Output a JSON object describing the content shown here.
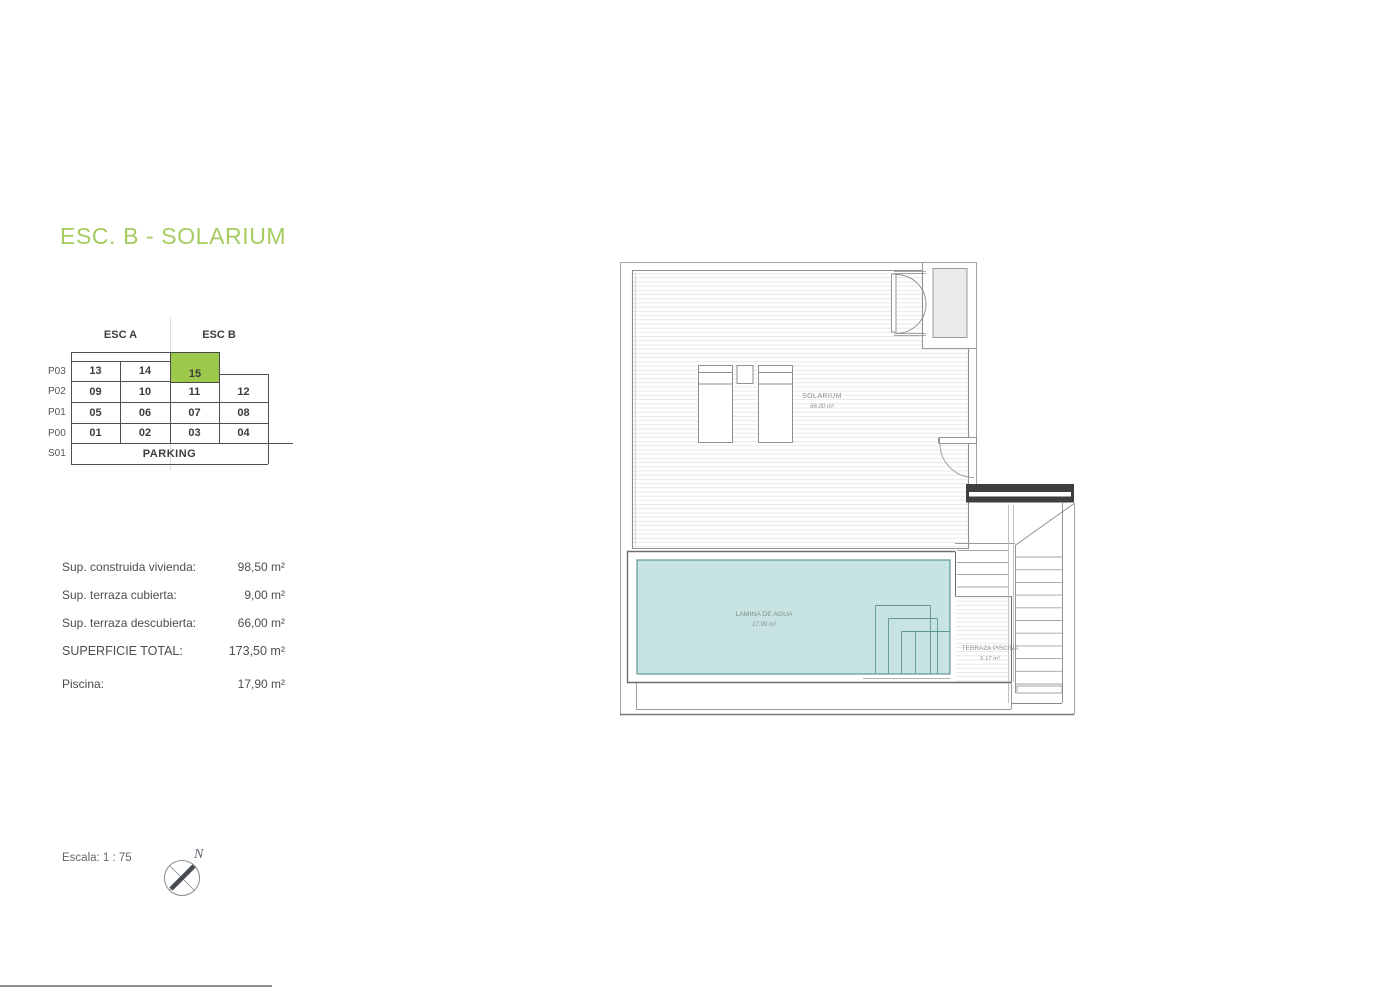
{
  "title": {
    "text": "ESC. B - SOLARIUM",
    "color": "#a6cb5f"
  },
  "unit_table": {
    "headers": [
      "ESC A",
      "ESC B"
    ],
    "rows": [
      {
        "label": "P03",
        "cells": [
          "13",
          "14",
          "15"
        ]
      },
      {
        "label": "P02",
        "cells": [
          "09",
          "10",
          "11",
          "12"
        ]
      },
      {
        "label": "P01",
        "cells": [
          "05",
          "06",
          "07",
          "08"
        ]
      },
      {
        "label": "P00",
        "cells": [
          "01",
          "02",
          "03",
          "04"
        ]
      }
    ],
    "basement": {
      "label": "S01",
      "value": "PARKING"
    },
    "highlighted_unit": "15",
    "highlight_color": "#9cc84c"
  },
  "surface_list": {
    "items": [
      {
        "label": "Sup. construida vivienda:",
        "value": "98,50 m²"
      },
      {
        "label": "Sup. terraza cubierta:",
        "value": "9,00 m²"
      },
      {
        "label": "Sup. terraza descubierta:",
        "value": "66,00 m²"
      },
      {
        "label": "SUPERFICIE TOTAL:",
        "value": "173,50 m²"
      },
      {
        "label": "Piscina:",
        "value": "17,90 m²"
      }
    ]
  },
  "floor_plan": {
    "rooms": [
      {
        "name": "SOLARIUM",
        "area": "66.00 m²"
      },
      {
        "name": "LAMINA DE AGUA",
        "area": "17.90 m²"
      },
      {
        "name": "TERRAZA PISCINA",
        "area": "6.17 m²"
      }
    ],
    "pool_color": "#c8e4e2"
  },
  "footer": {
    "scale_label": "Escala: 1 : 75",
    "compass_north": "N"
  }
}
